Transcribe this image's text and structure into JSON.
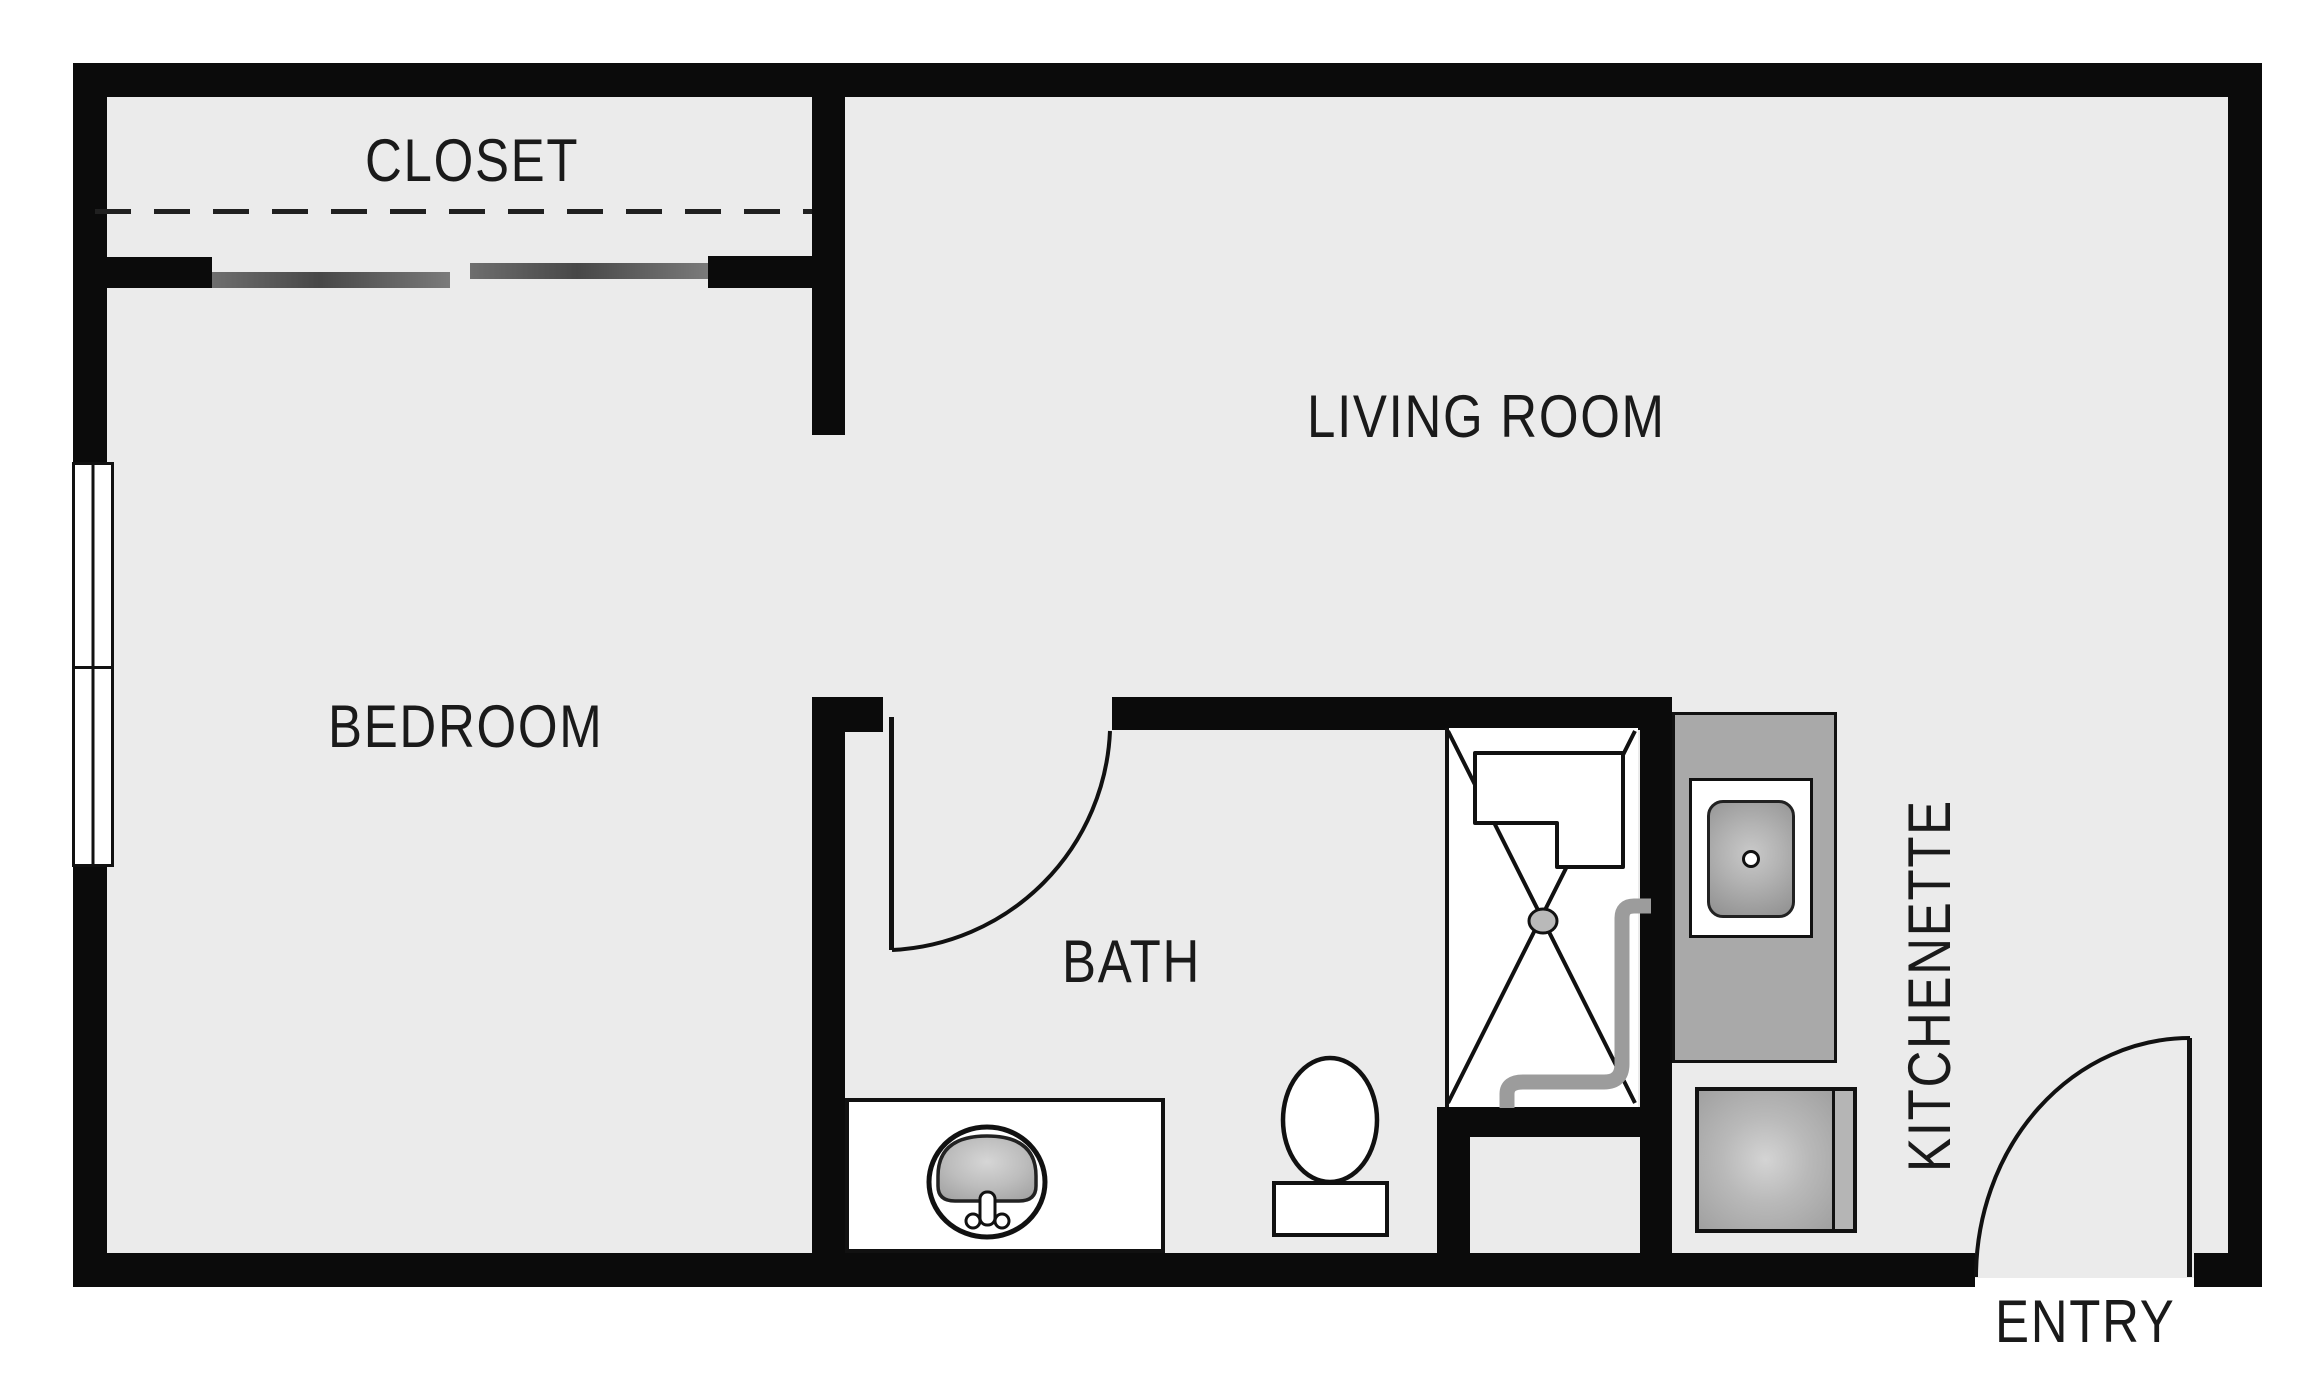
{
  "title": "Studio apartment floor plan",
  "labels": {
    "closet": "CLOSET",
    "living_room": "LIVING ROOM",
    "bedroom": "BEDROOM",
    "bath": "BATH",
    "kitchenette": "KITCHENETTE",
    "entry": "ENTRY"
  },
  "colors": {
    "wall": "#0b0b0b",
    "floor": "#ebebeb",
    "counter": "#a9a9a9",
    "text": "#1a1a1a",
    "pipe": "#9c9c9c",
    "background": "#ffffff"
  }
}
